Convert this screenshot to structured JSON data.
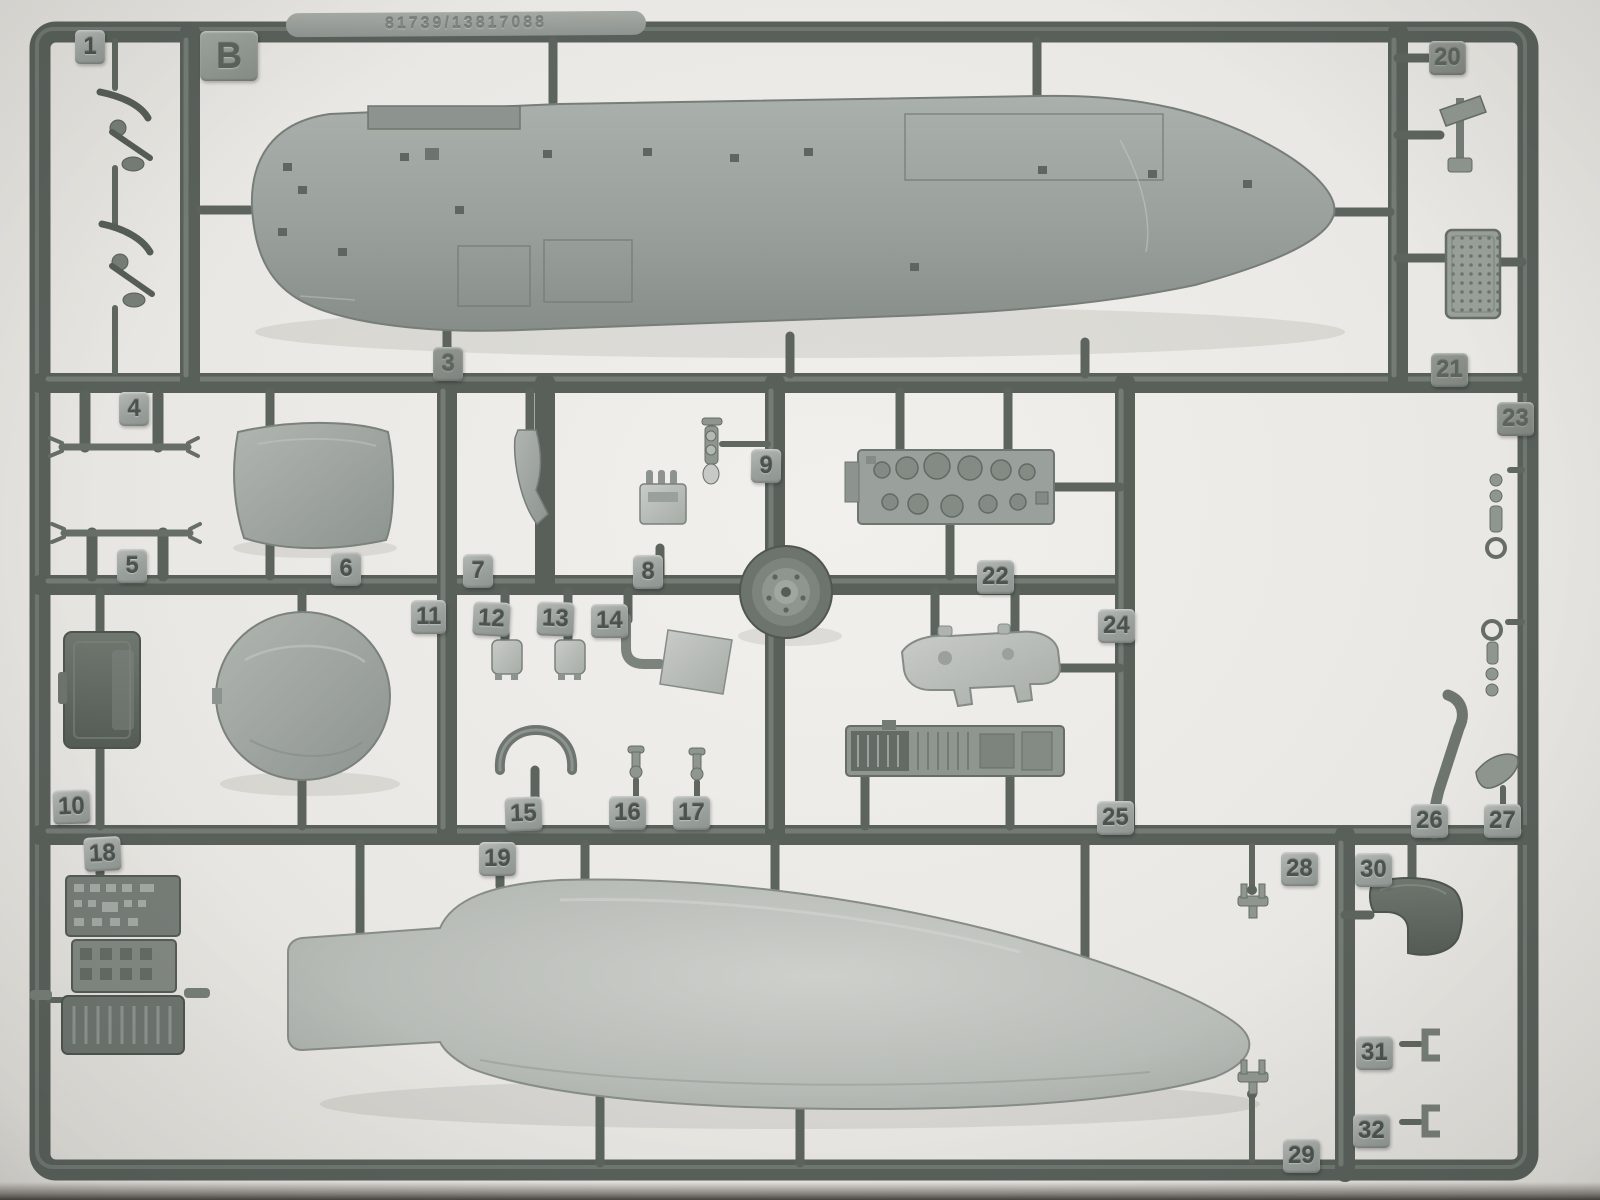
{
  "photo": {
    "sprue_letter": "B",
    "mold_text": "81739/13817088",
    "tags": {
      "b": "B",
      "n1": "1",
      "n3": "3",
      "n4": "4",
      "n5": "5",
      "n6": "6",
      "n7": "7",
      "n8": "8",
      "n9": "9",
      "n10": "10",
      "n11": "11",
      "n12": "12",
      "n13": "13",
      "n14": "14",
      "n15": "15",
      "n16": "16",
      "n17": "17",
      "n18": "18",
      "n19": "19",
      "n20": "20",
      "n21": "21",
      "n22": "22",
      "n23": "23",
      "n24": "24",
      "n25": "25",
      "n26": "26",
      "n27": "27",
      "n28": "28",
      "n29": "29",
      "n30": "30",
      "n31": "31",
      "n32": "32"
    },
    "colors": {
      "background": "#eae8e4",
      "runner_dark": "#59605a",
      "runner_highlight": "#7e847e",
      "part_mid": "#9aa09c",
      "part_light": "#bfc3bf",
      "part_dark": "#646b65",
      "tag_face": "#a9aeaa",
      "tag_text": "#4c534d"
    }
  }
}
